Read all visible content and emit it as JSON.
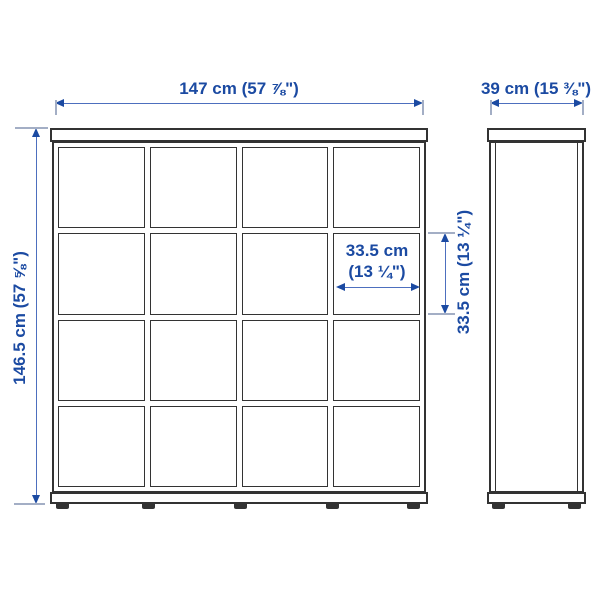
{
  "diagram_title": "shelf-unit-dimension-diagram",
  "front_view": {
    "grid": {
      "rows": 4,
      "columns": 4
    },
    "feet_count": 5,
    "width_label": "147 cm (57 ⅞\")",
    "height_label": "146.5 cm (57 ⅝\")",
    "cube_width_label_line1": "33.5 cm",
    "cube_width_label_line2": "(13 ¼\")",
    "cube_height_label": "33.5 cm (13 ¼\")"
  },
  "side_view": {
    "feet_count": 2,
    "depth_label": "39 cm (15 ⅜\")"
  },
  "colors": {
    "dimension_text": "#1b4aa2",
    "dimension_line": "#4d6fbe",
    "extension_line": "#a3aec5",
    "furniture_line": "#333333",
    "background": "#ffffff"
  }
}
